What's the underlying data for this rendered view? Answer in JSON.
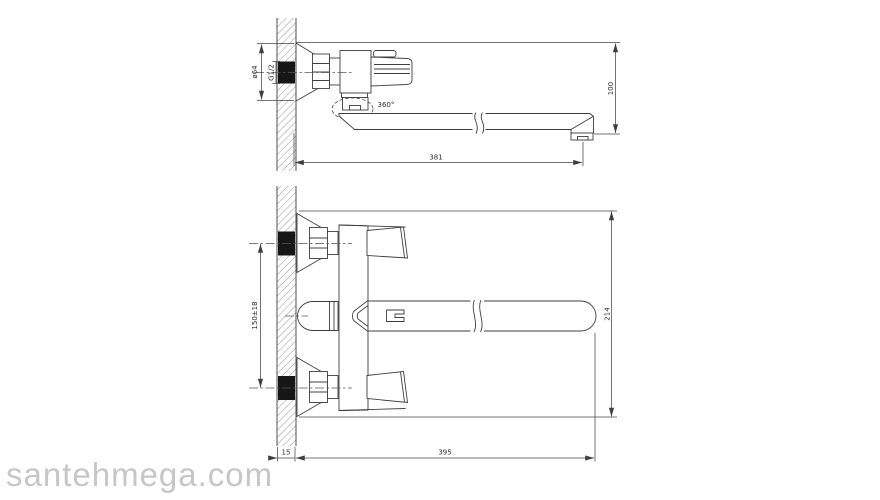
{
  "watermark": "santehmega.com",
  "side_view": {
    "label_escutcheon_diameter": "ø64",
    "label_thread": "G1/2",
    "label_swivel_rotation": "360°",
    "label_spout_reach": "381",
    "label_spout_height": "100"
  },
  "front_view": {
    "label_connection_spacing": "150±18",
    "label_overall_height": "214",
    "label_overall_length": "395",
    "label_wall_thickness": "15"
  },
  "colors": {
    "line": "#3f3f3f",
    "fitting_black": "#161616",
    "watermark_gray": "#c6c6c6",
    "background": "#ffffff"
  }
}
